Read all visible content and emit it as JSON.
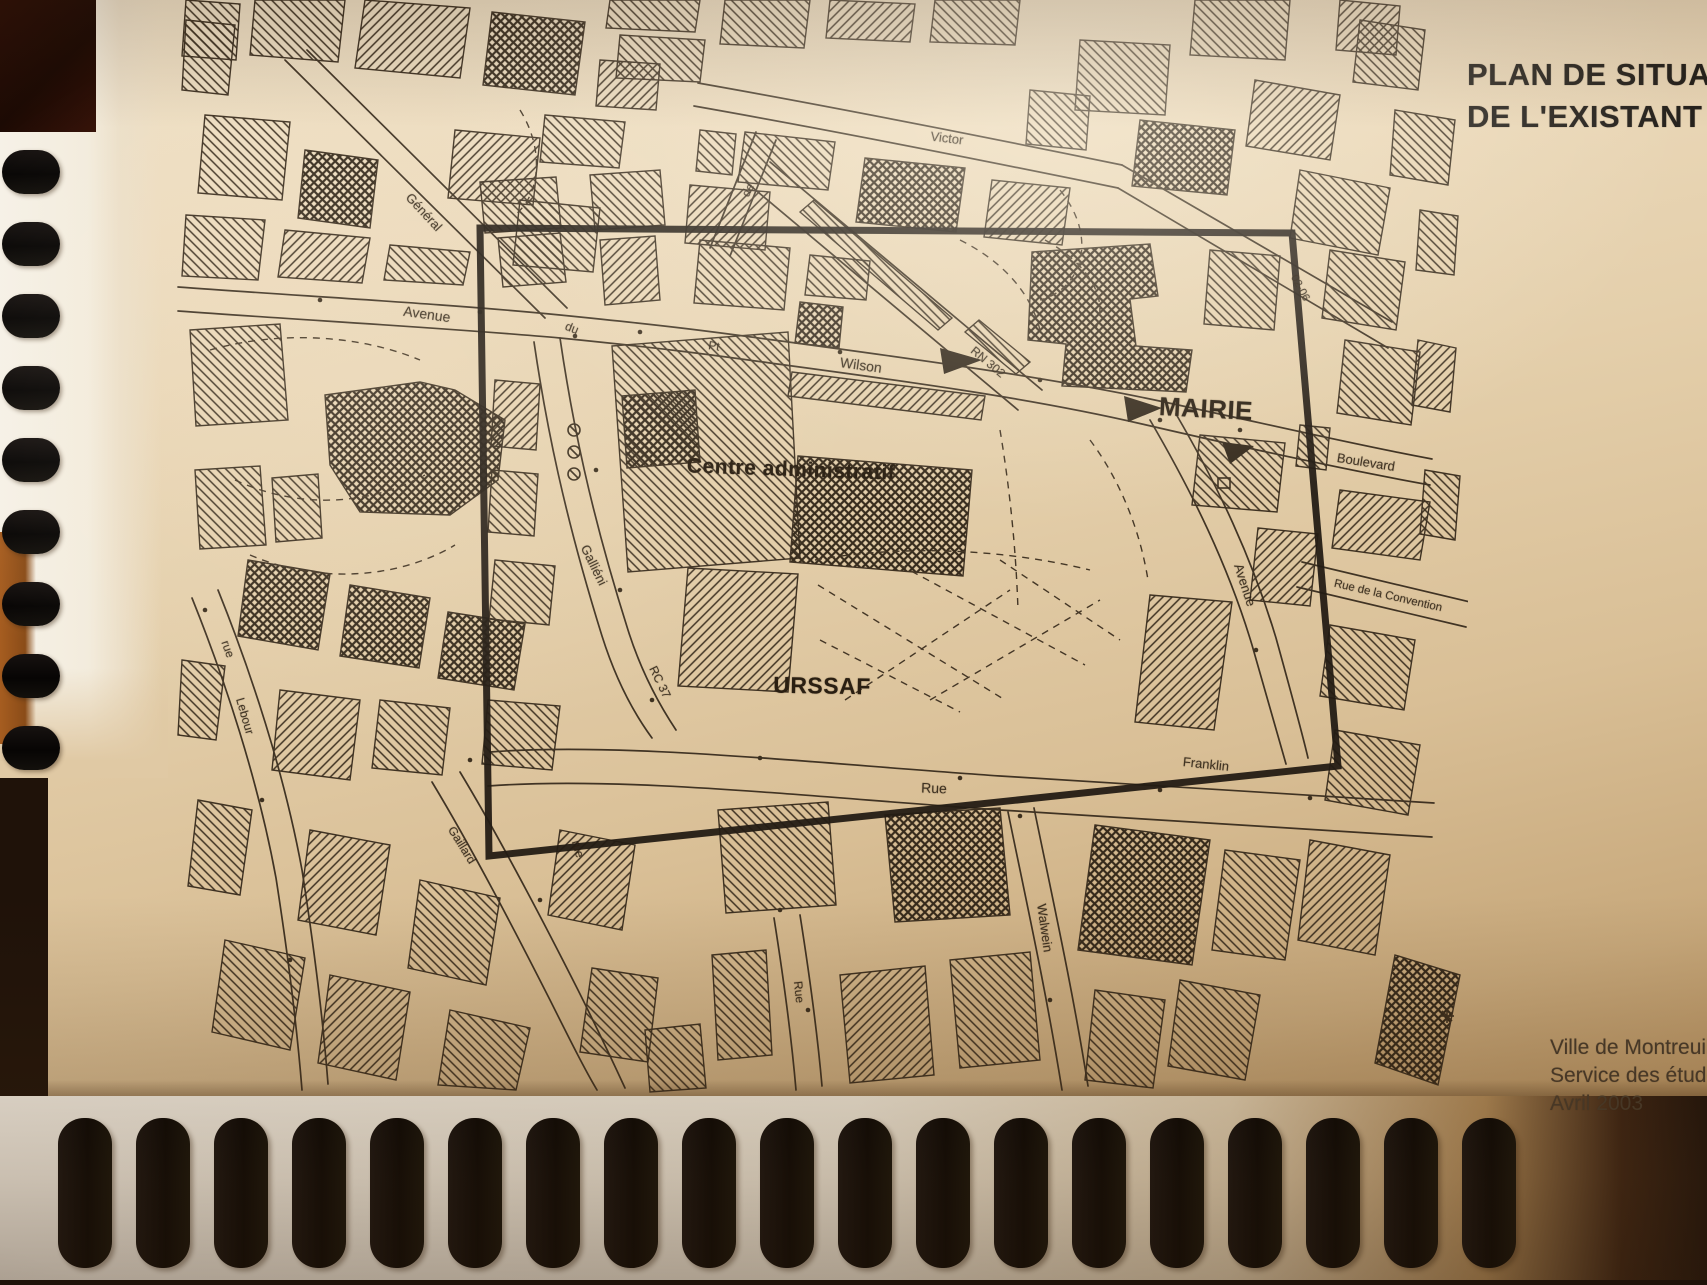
{
  "page_title": {
    "line1": "PLAN DE SITUATI",
    "line2": "DE L'EXISTANT"
  },
  "credits": [
    "Ville de Montreuil",
    "Service des études",
    "Avril 2003"
  ],
  "map": {
    "landmark_labels": [
      {
        "text": "Centre administratif",
        "x": 791,
        "y": 470,
        "rot": 2,
        "size": 21
      },
      {
        "text": "URSSAF",
        "x": 822,
        "y": 686,
        "rot": 1,
        "size": 23
      },
      {
        "text": "MAIRIE",
        "x": 1206,
        "y": 409,
        "rot": 3,
        "size": 26
      }
    ],
    "street_labels": [
      {
        "text": "Général",
        "x": 424,
        "y": 212,
        "rot": 47,
        "size": 13
      },
      {
        "text": "Avenue",
        "x": 427,
        "y": 314,
        "rot": 8,
        "size": 14
      },
      {
        "text": "du",
        "x": 572,
        "y": 328,
        "rot": 22,
        "size": 12
      },
      {
        "text": "de",
        "x": 748,
        "y": 190,
        "rot": -62,
        "size": 12
      },
      {
        "text": "Victor",
        "x": 947,
        "y": 138,
        "rot": 7,
        "size": 13
      },
      {
        "text": "Pt",
        "x": 714,
        "y": 346,
        "rot": 8,
        "size": 12
      },
      {
        "text": "Wilson",
        "x": 861,
        "y": 365,
        "rot": 8,
        "size": 14
      },
      {
        "text": "RN 302",
        "x": 988,
        "y": 362,
        "rot": 40,
        "size": 12
      },
      {
        "text": "02-06",
        "x": 1300,
        "y": 288,
        "rot": 62,
        "size": 11
      },
      {
        "text": "Boulevard",
        "x": 1366,
        "y": 462,
        "rot": 9,
        "size": 13
      },
      {
        "text": "Avenue",
        "x": 1245,
        "y": 585,
        "rot": 72,
        "size": 13
      },
      {
        "text": "Rue de la Convention",
        "x": 1388,
        "y": 596,
        "rot": 13,
        "size": 11.5
      },
      {
        "text": "Galliéni",
        "x": 594,
        "y": 565,
        "rot": 64,
        "size": 13
      },
      {
        "text": "RC 37",
        "x": 660,
        "y": 682,
        "rot": 64,
        "size": 12
      },
      {
        "text": "rue",
        "x": 228,
        "y": 649,
        "rot": 70,
        "size": 12
      },
      {
        "text": "Lebour",
        "x": 245,
        "y": 716,
        "rot": 74,
        "size": 12
      },
      {
        "text": "Rue",
        "x": 934,
        "y": 788,
        "rot": 2,
        "size": 14
      },
      {
        "text": "Franklin",
        "x": 1206,
        "y": 764,
        "rot": 6,
        "size": 13
      },
      {
        "text": "Gaillard",
        "x": 462,
        "y": 845,
        "rot": 58,
        "size": 12
      },
      {
        "text": "rue",
        "x": 578,
        "y": 849,
        "rot": 74,
        "size": 12
      },
      {
        "text": "Walwein",
        "x": 1045,
        "y": 928,
        "rot": 82,
        "size": 13
      },
      {
        "text": "Rue",
        "x": 799,
        "y": 992,
        "rot": 84,
        "size": 12
      }
    ]
  },
  "colors": {
    "paper": "#e9d6b6",
    "ink": "#2a1f12",
    "frame": "#16100a",
    "coil": "#0c0906",
    "title_ink": "#25211c"
  }
}
